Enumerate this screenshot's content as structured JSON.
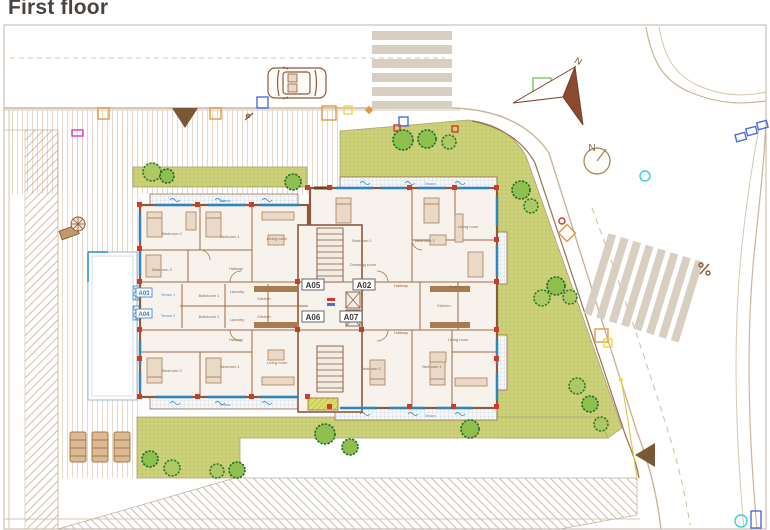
{
  "title": "First floor",
  "compass": {
    "arrow_label": "N",
    "circle_label": "N"
  },
  "building": {
    "core_labels": [
      {
        "text": "A05"
      },
      {
        "text": "A02"
      },
      {
        "text": "A06"
      },
      {
        "text": "A07"
      }
    ],
    "balcony_labels": [
      {
        "text": "A03"
      },
      {
        "text": "A04"
      }
    ],
    "room_labels": [
      {
        "text": "Bedroom 2"
      },
      {
        "text": "Bedroom 1"
      },
      {
        "text": "Living room"
      },
      {
        "text": "Bedroom 3"
      },
      {
        "text": "Hallway"
      },
      {
        "text": "Kitchen"
      },
      {
        "text": "Laundry"
      },
      {
        "text": "Bedroom 1"
      },
      {
        "text": "Bedroom 2"
      },
      {
        "text": "Dressing room"
      },
      {
        "text": "Bedroom 3"
      },
      {
        "text": "Hallway"
      },
      {
        "text": "Living room"
      },
      {
        "text": "Kitchen"
      },
      {
        "text": "Laundry"
      },
      {
        "text": "Bedroom 2"
      },
      {
        "text": "Bedroom 1"
      },
      {
        "text": "Living room"
      },
      {
        "text": "Hallway"
      },
      {
        "text": "Bedroom 2"
      },
      {
        "text": "Bedroom 1"
      },
      {
        "text": "Living room"
      },
      {
        "text": "Hallway"
      },
      {
        "text": "Bathroom 1"
      },
      {
        "text": "Bathroom 2"
      },
      {
        "text": "Kitchen"
      }
    ],
    "terrace_labels": [
      {
        "text": "Terrace 1"
      },
      {
        "text": "Terrace 2"
      },
      {
        "text": "Terrace"
      },
      {
        "text": "Terrace"
      },
      {
        "text": "Terrace"
      },
      {
        "text": "Terrace"
      }
    ]
  },
  "colors": {
    "wall": "#8a5a3c",
    "lawn": "#cbd079",
    "window": "#2e86c1",
    "column_marker": "#d03a28",
    "road_line": "#c9b49c",
    "crosswalk": "#d8cec2",
    "tree_dark": "#2f7a2c",
    "tree_light": "#6fae3e"
  }
}
